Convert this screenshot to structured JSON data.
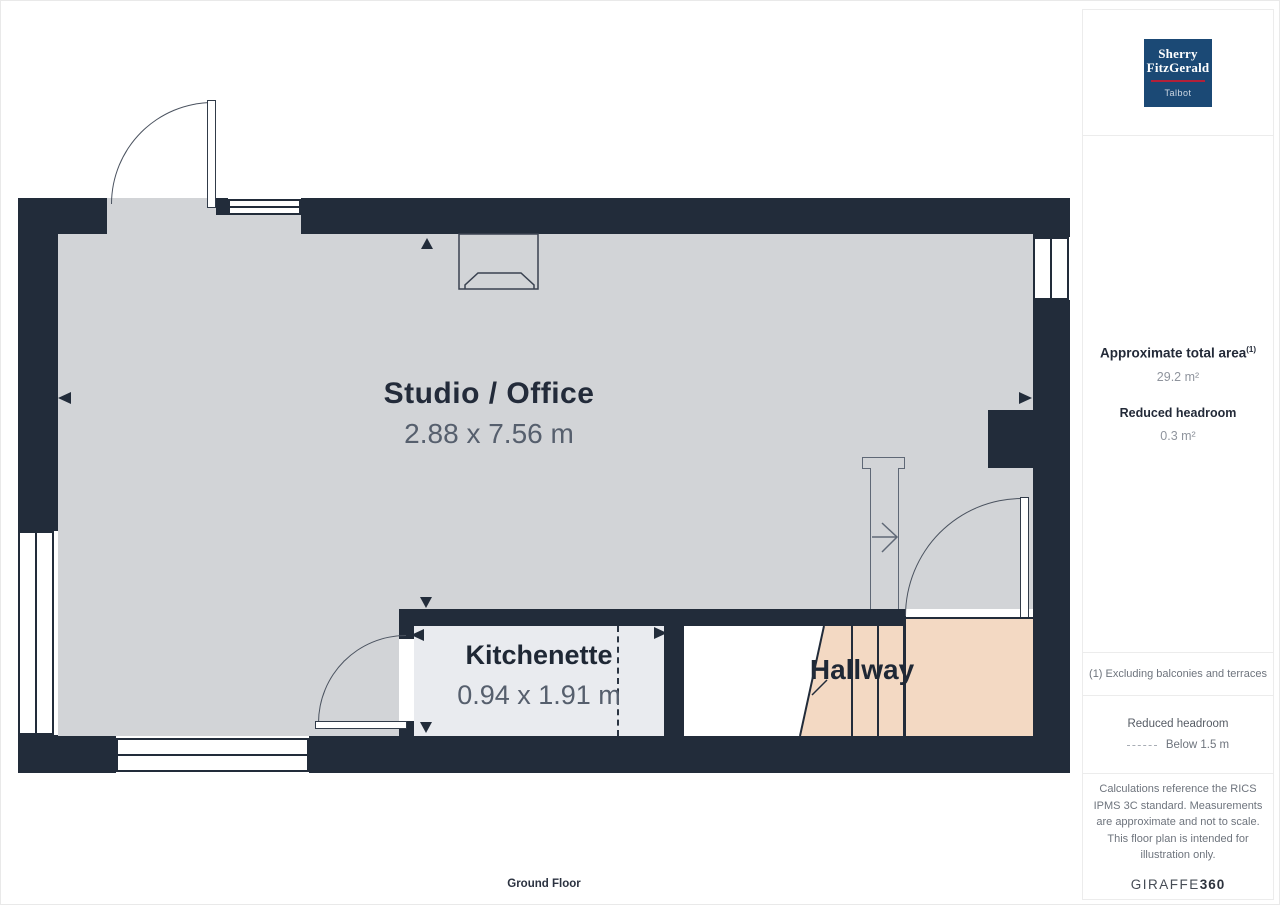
{
  "plan": {
    "floor_label": "Ground Floor",
    "rooms": {
      "studio": {
        "name": "Studio / Office",
        "dims": "2.88 x 7.56 m"
      },
      "kitchenette": {
        "name": "Kitchenette",
        "dims": "0.94 x 1.91 m"
      },
      "hallway": {
        "name": "Hallway"
      }
    },
    "colors": {
      "wall": "#222c3a",
      "floor": "#d2d4d7",
      "kitchenette_floor": "#e9ebef",
      "hallway_floor": "#ffffff",
      "stairs_reduced_headroom": "#f3d9c3"
    }
  },
  "sidebar": {
    "area_title": "Approximate total area",
    "area_footnote_marker": "(1)",
    "area_value": "29.2 m²",
    "headroom_title": "Reduced headroom",
    "headroom_value": "0.3 m²",
    "footnote": "(1) Excluding balconies and terraces",
    "legend_title": "Reduced headroom",
    "legend_label": "Below 1.5 m",
    "disclaimer": "Calculations reference the RICS IPMS 3C standard. Measurements are approximate and not to scale. This floor plan is intended for illustration only."
  },
  "branding": {
    "agency_line1": "Sherry",
    "agency_line2": "FitzGerald",
    "agency_sub": "Talbot",
    "provider_name": "GIRAFFE",
    "provider_suffix": "360",
    "logo_bg": "#1b4975",
    "logo_underline": "#b32038"
  }
}
